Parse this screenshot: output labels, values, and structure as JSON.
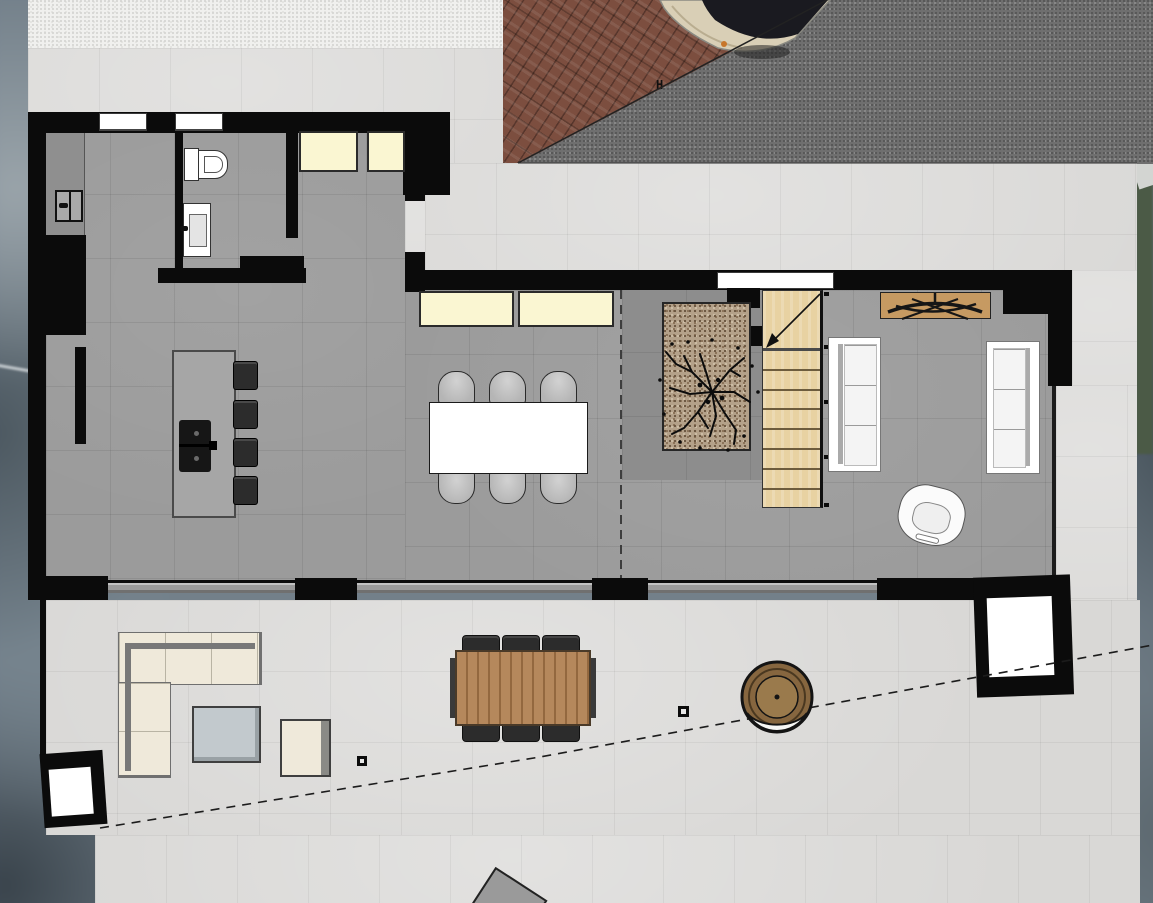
{
  "scene": {
    "type": "architectural floor plan, top-down 2D render",
    "floor": "ground floor open-plan house with terrace and driveway",
    "boundary_marker_label": "H"
  },
  "palette": {
    "wall": "#0b0b0b",
    "interior_floor": "#9b9b9b",
    "interior_floor_dark": "#8d8d8d",
    "exterior_tile": "#d9d8d6",
    "sidewalk": "#f0f0ee",
    "asphalt": "#6f6f6f",
    "brick": "#7c4e3f",
    "stair_wood": "#e8d2a2",
    "planter_gravel": "#b4a189",
    "cabinet_cream": "#faf6d2",
    "window_white": "#ffffff",
    "outdoor_cream": "#efe9da",
    "wood_console": "#c69a62",
    "outdoor_wood": "#b5885c",
    "dark_seat": "#2c2c2c",
    "hedge_green": "#4b5a46",
    "car_body": "#d9cfb6",
    "coffee_table_gray": "#c2c9cd"
  },
  "rooms": [
    {
      "name": "kitchen"
    },
    {
      "name": "bathroom"
    },
    {
      "name": "entry-hall"
    },
    {
      "name": "dining-area"
    },
    {
      "name": "stair-hall-with-planter"
    },
    {
      "name": "living-room"
    },
    {
      "name": "terrace"
    },
    {
      "name": "brick-driveway"
    },
    {
      "name": "street-asphalt"
    },
    {
      "name": "sidewalk"
    }
  ],
  "furniture_interior": [
    {
      "name": "kitchen-island-with-cooktop"
    },
    {
      "name": "bar-stools",
      "count": 4
    },
    {
      "name": "left-wall-counter-with-double-sink"
    },
    {
      "name": "tall-black-cabinets"
    },
    {
      "name": "toilet"
    },
    {
      "name": "washbasin-vanity"
    },
    {
      "name": "cream-sideboards",
      "count": 4
    },
    {
      "name": "dining-table"
    },
    {
      "name": "dining-chairs",
      "count": 6
    },
    {
      "name": "indoor-planter-with-tree"
    },
    {
      "name": "wooden-staircase",
      "treads": 8
    },
    {
      "name": "coat-rack-console-with-hangers"
    },
    {
      "name": "white-sofas",
      "count": 2
    },
    {
      "name": "white-armchair"
    }
  ],
  "furniture_exterior": [
    {
      "name": "corner-lounge-sofa"
    },
    {
      "name": "outdoor-coffee-table"
    },
    {
      "name": "lounge-ottoman"
    },
    {
      "name": "outdoor-dining-table-wood"
    },
    {
      "name": "outdoor-chairs",
      "count": 6
    },
    {
      "name": "round-wicker-chair"
    },
    {
      "name": "framed-white-planters",
      "count": 2
    },
    {
      "name": "floor-drains",
      "count": 2
    },
    {
      "name": "parked-car"
    }
  ]
}
